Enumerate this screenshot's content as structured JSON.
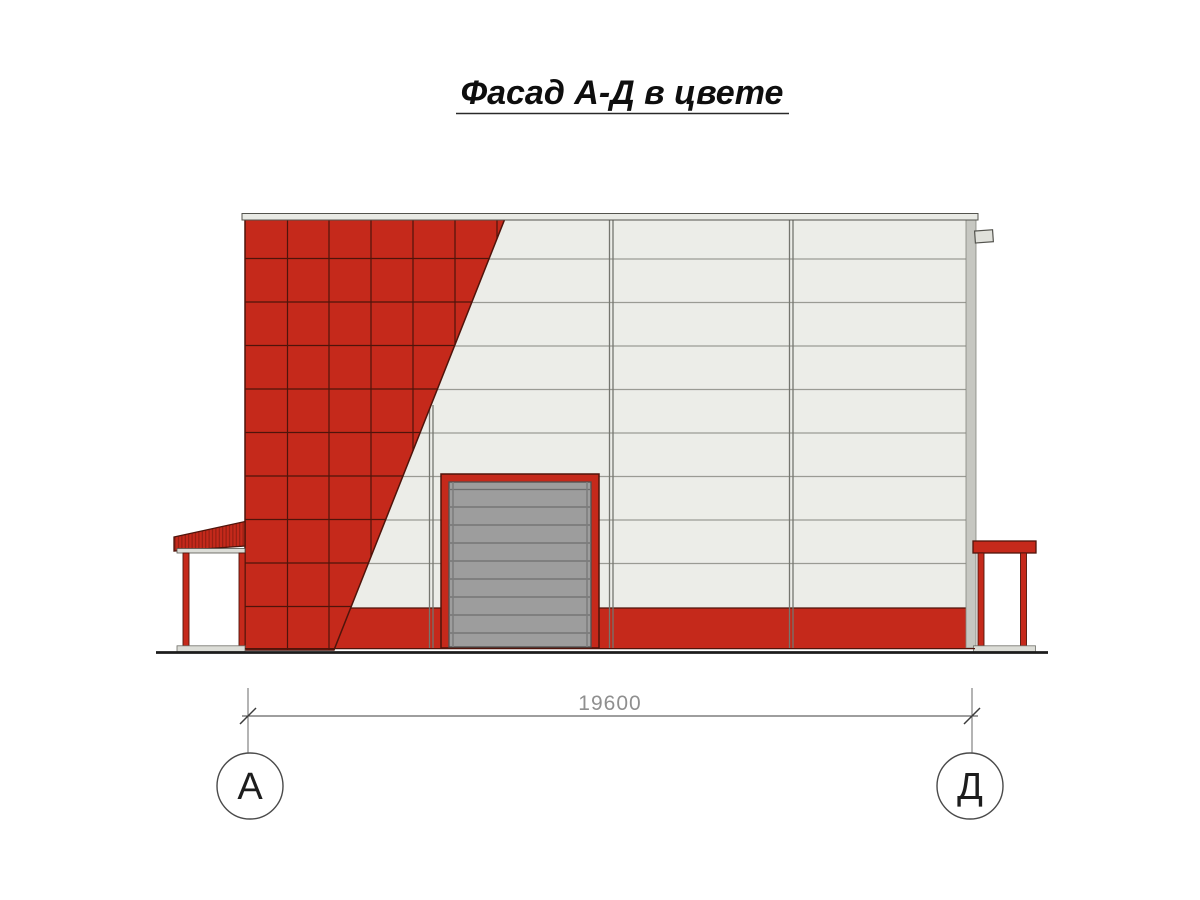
{
  "title": {
    "text": "Фасад А-Д в цвете"
  },
  "dimension": {
    "length_label": "19600"
  },
  "axis_markers": {
    "left": "А",
    "right": "Д"
  },
  "watermark": {
    "text": "АЛЬЯНС"
  },
  "colors": {
    "facade_red": "#c5291b",
    "grid_line": "#4f140b",
    "panel_white": "#ecede8",
    "panel_line": "#9a9b94",
    "joint_line": "#75766f",
    "door_gray": "#9d9d9d",
    "door_line": "#6e6e6e",
    "coping_gray": "#e9eae5",
    "metal_light": "#dcddd7",
    "ground_black": "#1c1c1c",
    "dim_gray": "#8f8f8f",
    "line_dark": "#3c3c3c",
    "title_black": "#0e0e0e"
  }
}
